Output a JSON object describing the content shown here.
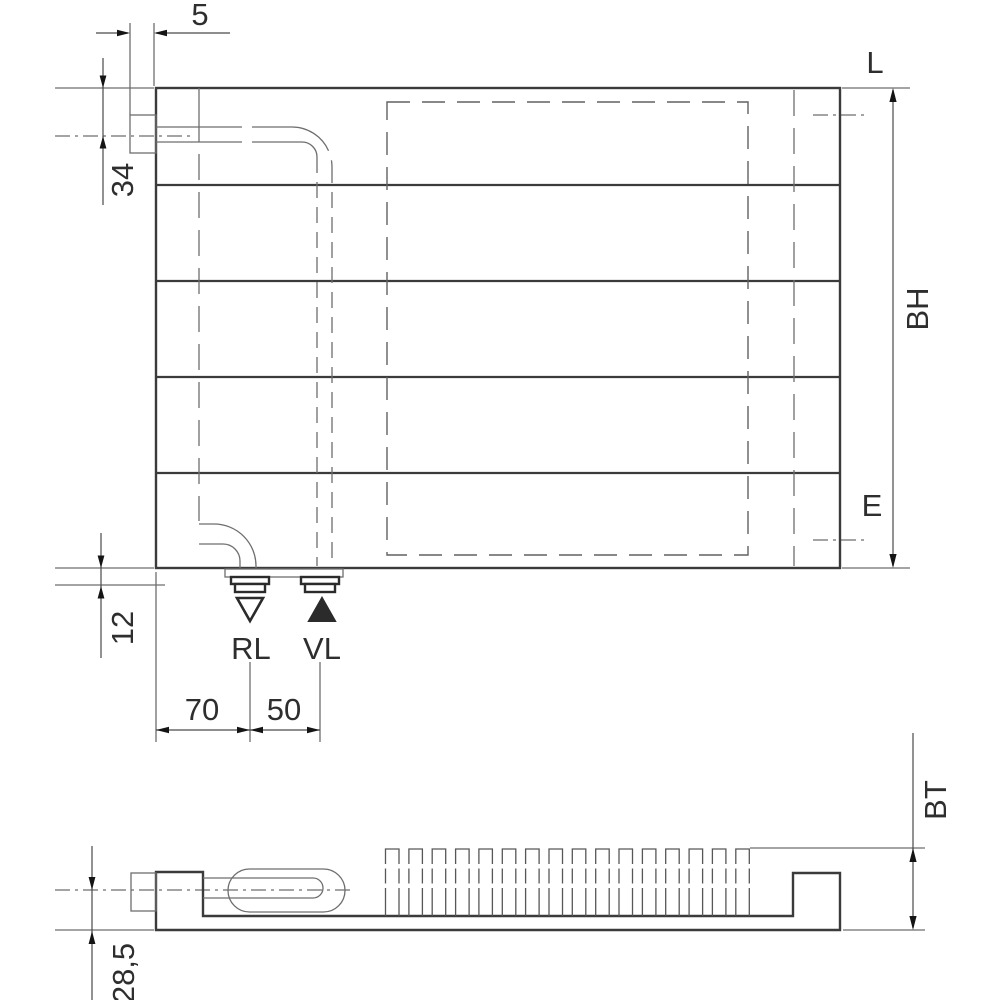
{
  "front_view": {
    "dim_5": "5",
    "dim_34": "34",
    "dim_12": "12",
    "dim_70": "70",
    "dim_50": "50",
    "label_L": "L",
    "label_BH": "BH",
    "label_E": "E",
    "label_RL": "RL",
    "label_VL": "VL"
  },
  "bottom_view": {
    "label_BT": "BT",
    "dim_28_5": "28,5"
  },
  "symbols": {
    "return_flow": "open-triangle-down",
    "supply_flow": "filled-triangle-up"
  },
  "colors": {
    "line_bold": "#3b3b3b",
    "line_thin": "#6e6e6e",
    "dimension": "#4a4a4a",
    "arrow_fill": "#141414",
    "text": "#2e2e2e",
    "background": "#ffffff"
  }
}
